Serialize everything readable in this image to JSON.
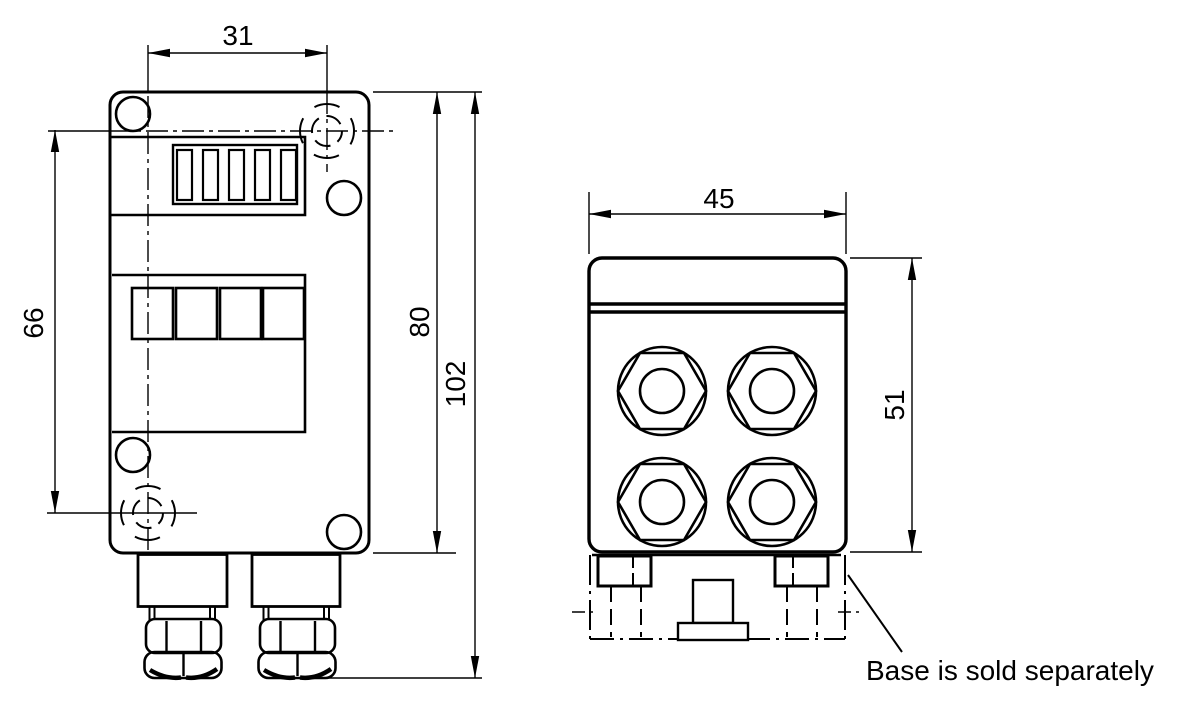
{
  "dimensions": {
    "d31": "31",
    "d66": "66",
    "d80": "80",
    "d102": "102",
    "d45": "45",
    "d51": "51"
  },
  "note": {
    "base_note": "Base is sold separately"
  },
  "colors": {
    "line": "#000000",
    "background": "#ffffff"
  }
}
